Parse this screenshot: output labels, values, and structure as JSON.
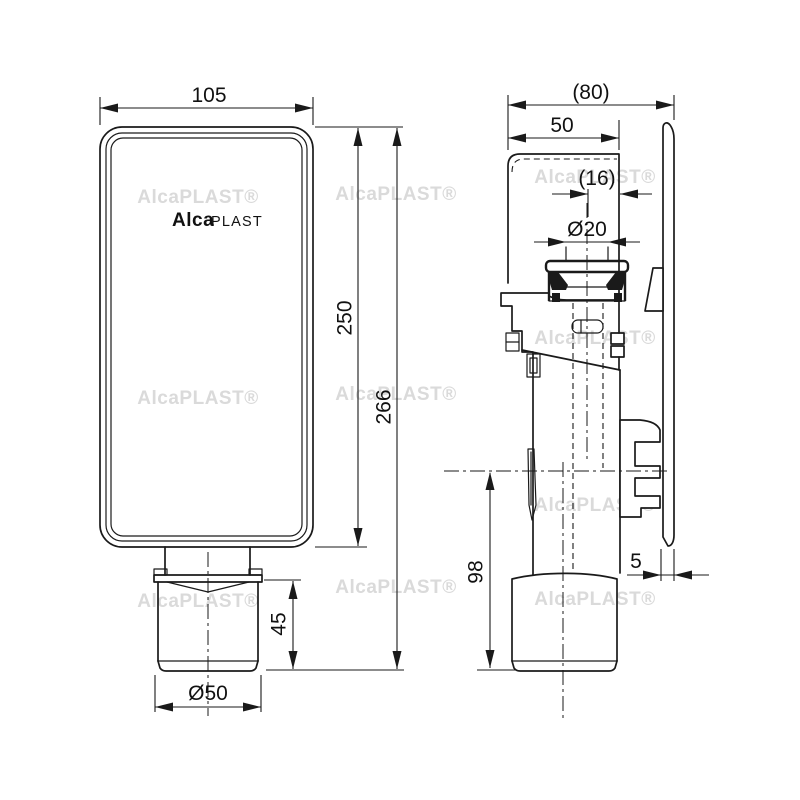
{
  "drawing_title": "AlcaPlast siphon technical drawing",
  "watermark": {
    "text": "AlcaPLAST®"
  },
  "front_view": {
    "logo": {
      "bold": "Alca",
      "light": "PLAST"
    },
    "dims": {
      "width": "105",
      "body_height": "250",
      "total_height": "266",
      "outlet_height": "45",
      "outlet_diameter": "Ø50"
    }
  },
  "side_view": {
    "dims": {
      "total_depth": "(80)",
      "body_depth": "50",
      "inlet_offset": "(16)",
      "inlet_diameter": "Ø20",
      "outlet_drop": "98",
      "plate_gap": "5"
    }
  },
  "colors": {
    "line": "#1a1a1a",
    "background": "#ffffff",
    "watermark": "#dadada"
  }
}
